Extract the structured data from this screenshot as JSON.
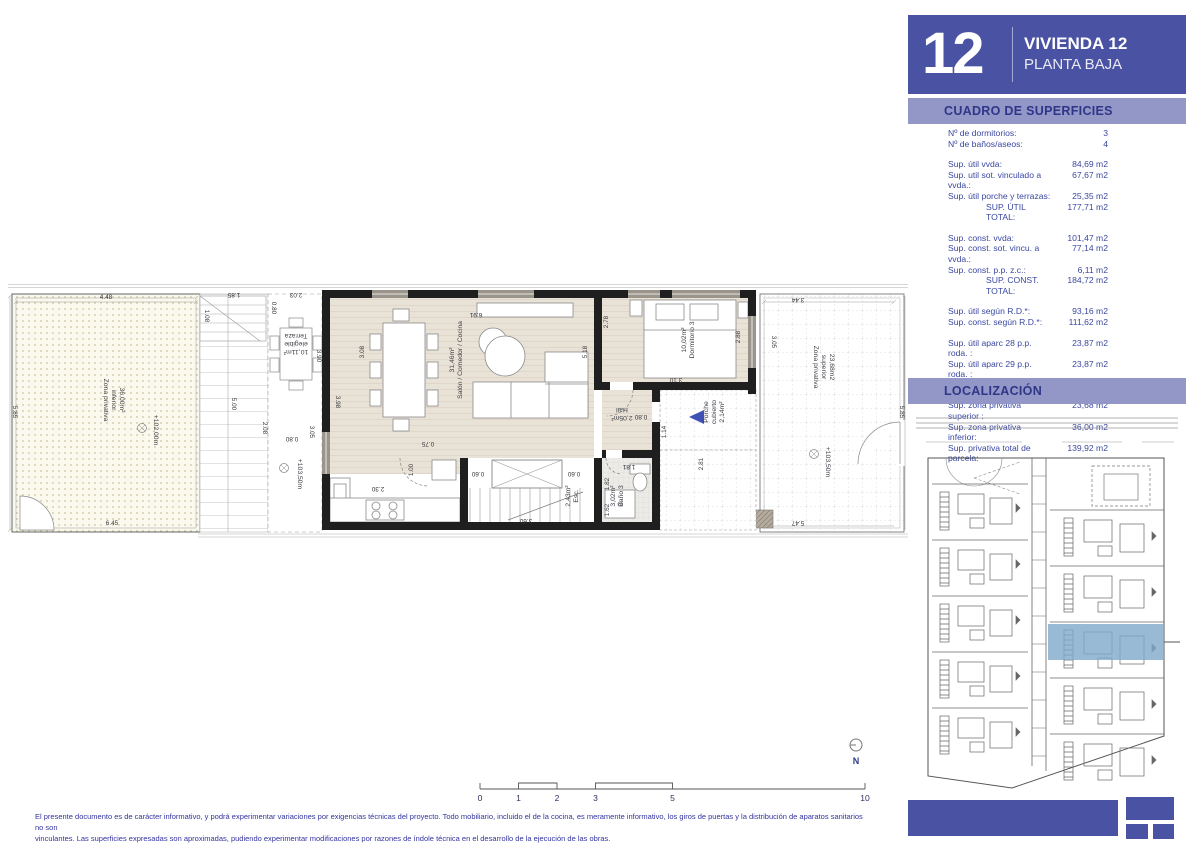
{
  "sidebar": {
    "number": "12",
    "title": "VIVIENDA 12",
    "subtitle": "PLANTA BAJA",
    "surfaces_title": "CUADRO DE SUPERFICIES",
    "location_title": "LOCALIZACIÓN",
    "groups": [
      [
        {
          "label": "Nº de dormitorios:",
          "value": "3"
        },
        {
          "label": "Nº de baños/aseos:",
          "value": "4"
        }
      ],
      [
        {
          "label": "Sup. útil vvda:",
          "value": "84,69 m2"
        },
        {
          "label": "Sup. util sot. vinculado a vvda.:",
          "value": "67,67 m2"
        },
        {
          "label": "Sup. útil porche y terrazas:",
          "value": "25,35 m2"
        },
        {
          "label": "SUP. ÚTIL TOTAL:",
          "value": "177,71 m2",
          "total": true
        }
      ],
      [
        {
          "label": "Sup. const. vvda:",
          "value": "101,47 m2"
        },
        {
          "label": "Sup. const. sot. vincu. a vvda.:",
          "value": "77,14 m2"
        },
        {
          "label": "Sup. const. p.p. z.c.:",
          "value": "6,11 m2"
        },
        {
          "label": "SUP. CONST. TOTAL:",
          "value": "184,72 m2",
          "total": true
        }
      ],
      [
        {
          "label": "Sup. útil según R.D.*:",
          "value": "93,16 m2"
        },
        {
          "label": "Sup. const. según R.D.*:",
          "value": "111,62 m2"
        }
      ],
      [
        {
          "label": "Sup. útil aparc 28 p.p. roda. :",
          "value": "23,87 m2"
        },
        {
          "label": "Sup. útil aparc 29 p.p. roda. :",
          "value": "23,87 m2"
        },
        {
          "label": "Sup. solarium:",
          "value": "41,86 m2"
        }
      ],
      [
        {
          "label": "Sup. zona privativa superior :",
          "value": "23,68 m2"
        },
        {
          "label": "Sup. zona privativa inferior:",
          "value": "36,00 m2"
        },
        {
          "label": "Sup. privativa total de parcela:",
          "value": "139,92 m2"
        }
      ]
    ]
  },
  "plan": {
    "rooms": [
      {
        "lines": [
          "Zona privativa",
          "inferior",
          "36,00m²"
        ],
        "x": 96,
        "y": 118,
        "r": 90
      },
      {
        "lines": [
          "+102,00m"
        ],
        "x": 146,
        "y": 148,
        "r": 90,
        "s": 6.3
      },
      {
        "lines": [
          "Terraza",
          "elegible",
          "10,11m²"
        ],
        "x": 288,
        "y": 52,
        "r": 180,
        "s": 6.3
      },
      {
        "lines": [
          "+103,50m"
        ],
        "x": 290,
        "y": 192,
        "r": 90,
        "s": 6.3
      },
      {
        "lines": [
          "31,46m²",
          "Salón / Comedor / Cocina"
        ],
        "x": 446,
        "y": 78,
        "r": -90
      },
      {
        "lines": [
          "10,02m²",
          "Dormitorio 3"
        ],
        "x": 678,
        "y": 58,
        "r": -90
      },
      {
        "lines": [
          "Hall",
          "2,05m²"
        ],
        "x": 614,
        "y": 126,
        "r": 180,
        "s": 6.3
      },
      {
        "lines": [
          "Porche",
          "cubierto",
          "2,14m²"
        ],
        "x": 700,
        "y": 130,
        "r": -90,
        "s": 6.3
      },
      {
        "lines": [
          "3,02m²",
          "Baño 3"
        ],
        "x": 607,
        "y": 214,
        "r": -90,
        "s": 6.3
      },
      {
        "lines": [
          "2,43m²",
          "Esc."
        ],
        "x": 562,
        "y": 214,
        "r": -90,
        "s": 6.3
      },
      {
        "lines": [
          "Zona privativa",
          "superior",
          "23,68m2"
        ],
        "x": 806,
        "y": 85,
        "r": 90
      },
      {
        "lines": [
          "+103,50m"
        ],
        "x": 818,
        "y": 180,
        "r": 90,
        "s": 6.3
      }
    ],
    "dims": [
      {
        "t": "4.48",
        "x": 98,
        "y": 17,
        "r": 0
      },
      {
        "t": "5.85",
        "x": 5,
        "y": 130,
        "r": 90
      },
      {
        "t": "6.45",
        "x": 104,
        "y": 243,
        "r": 0
      },
      {
        "t": "5.00",
        "x": 224,
        "y": 122,
        "r": 90
      },
      {
        "t": "1.85",
        "x": 226,
        "y": 11,
        "r": 180
      },
      {
        "t": "1.08",
        "x": 197,
        "y": 34,
        "r": 90
      },
      {
        "t": "0.80",
        "x": 264,
        "y": 26,
        "r": 90
      },
      {
        "t": "2.03",
        "x": 288,
        "y": 11,
        "r": 180
      },
      {
        "t": "3.90",
        "x": 309,
        "y": 74,
        "r": 90
      },
      {
        "t": "2.08",
        "x": 255,
        "y": 146,
        "r": 90
      },
      {
        "t": "0.80",
        "x": 284,
        "y": 155,
        "r": 180
      },
      {
        "t": "3.05",
        "x": 302,
        "y": 150,
        "r": 90
      },
      {
        "t": "3.08",
        "x": 356,
        "y": 70,
        "r": -90
      },
      {
        "t": "6.91",
        "x": 468,
        "y": 31,
        "r": 180
      },
      {
        "t": "5.18",
        "x": 579,
        "y": 70,
        "r": -90
      },
      {
        "t": "2.78",
        "x": 600,
        "y": 40,
        "r": -90
      },
      {
        "t": "2.88",
        "x": 732,
        "y": 55,
        "r": -90
      },
      {
        "t": "3.10",
        "x": 668,
        "y": 96,
        "r": 180
      },
      {
        "t": "0.75",
        "x": 420,
        "y": 160,
        "r": 180
      },
      {
        "t": "1.00",
        "x": 405,
        "y": 188,
        "r": -90
      },
      {
        "t": "2.30",
        "x": 370,
        "y": 205,
        "r": 180
      },
      {
        "t": "3.98",
        "x": 328,
        "y": 120,
        "r": 90
      },
      {
        "t": "0.60",
        "x": 470,
        "y": 190,
        "r": 180
      },
      {
        "t": "0.60",
        "x": 566,
        "y": 190,
        "r": 180
      },
      {
        "t": "3.60",
        "x": 518,
        "y": 237,
        "r": 180
      },
      {
        "t": "0.80",
        "x": 633,
        "y": 133,
        "r": 180
      },
      {
        "t": "1.14",
        "x": 658,
        "y": 150,
        "r": -90
      },
      {
        "t": "2.81",
        "x": 695,
        "y": 182,
        "r": -90
      },
      {
        "t": "1.81",
        "x": 621,
        "y": 183,
        "r": 180
      },
      {
        "t": "1.82",
        "x": 601,
        "y": 202,
        "r": -90
      },
      {
        "t": "1.62",
        "x": 601,
        "y": 228,
        "r": -90
      },
      {
        "t": "3.44",
        "x": 790,
        "y": 16,
        "r": 180
      },
      {
        "t": "3.05",
        "x": 764,
        "y": 60,
        "r": 90
      },
      {
        "t": "5.85",
        "x": 892,
        "y": 130,
        "r": 90
      },
      {
        "t": "5.47",
        "x": 790,
        "y": 239,
        "r": 180
      }
    ]
  },
  "scalebar": {
    "labels": [
      {
        "t": "0",
        "x": 8
      },
      {
        "t": "1",
        "x": 46.5
      },
      {
        "t": "2",
        "x": 85
      },
      {
        "t": "3",
        "x": 123.5
      },
      {
        "t": "5",
        "x": 200.5
      },
      {
        "t": "10",
        "x": 393
      }
    ]
  },
  "north": "N",
  "disclaimer": {
    "line1": "El presente documento es de carácter informativo, y podrá experimentar variaciones por exigencias técnicas del proyecto. Todo mobiliario, incluido el de la cocina, es meramente informativo, los giros de puertas y la distribución de aparatos sanitarios no son",
    "line2": "vinculantes. Las superficies expresadas son aproximadas, pudiendo experimentar modificaciones por razones de índole técnica en el desarrollo de la ejecución de las obras."
  }
}
